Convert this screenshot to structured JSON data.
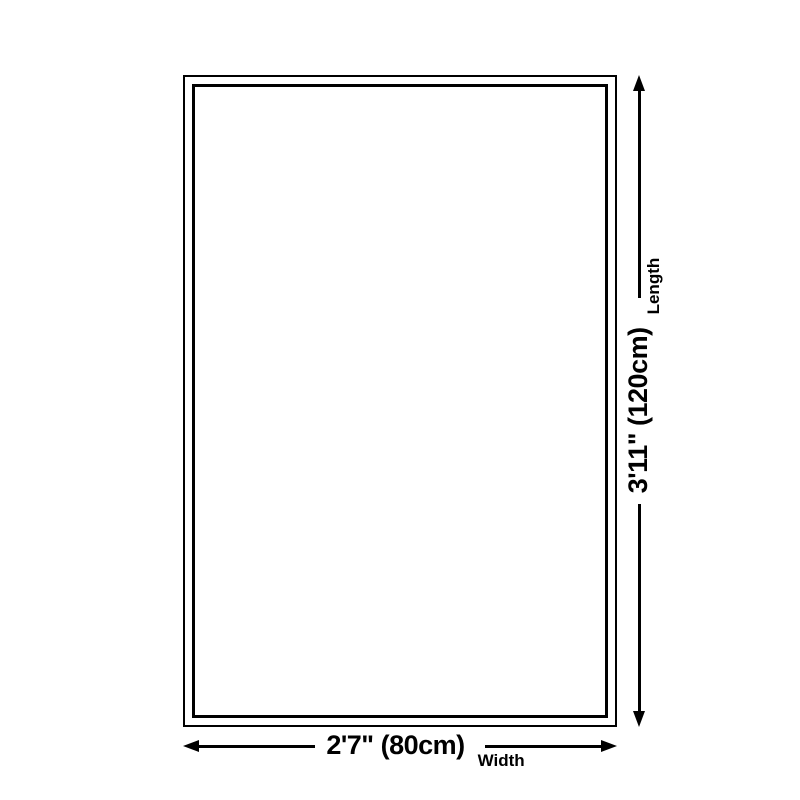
{
  "diagram": {
    "background": "#ffffff",
    "line_color": "#000000",
    "width_dimension": {
      "value": "2'7\" (80cm)",
      "label": "Width"
    },
    "length_dimension": {
      "value": "3'11\" (120cm)",
      "label": "Length"
    }
  }
}
